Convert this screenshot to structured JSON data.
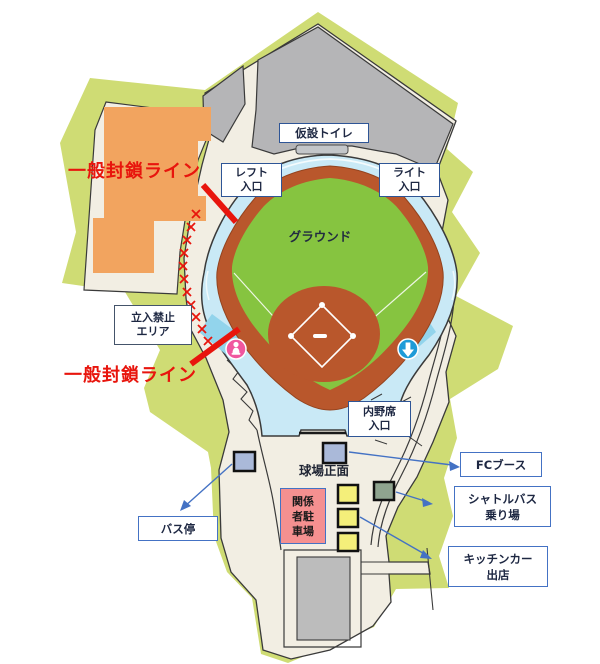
{
  "map": {
    "labels": {
      "temp_toilet": "仮設トイレ",
      "left_entrance": "レフト\n入口",
      "right_entrance": "ライト\n入口",
      "ground": "グラウンド",
      "restricted_area": "立入禁止\nエリア",
      "closure_line_upper": "一般封鎖ライン",
      "closure_line_lower": "一般封鎖ライン",
      "infield_entrance": "内野席\n入口",
      "stadium_front": "球場正面",
      "staff_parking": "関係\n者駐\n車場",
      "bus_stop": "バス停",
      "fc_booth": "FCブース",
      "shuttle_bus": "シャトルバス\n乗り場",
      "kitchen_car": "キッチンカー\n出店"
    },
    "icons": {
      "person_marker": "pink circle with white person glyph",
      "entrance_arrow": "blue circle with white down arrow",
      "closure_x_marks": "red x chain along closed path"
    },
    "colors": {
      "park_green": "#cfdc74",
      "ground_beige": "#f2eee3",
      "structure_gray": "#b5b5b7",
      "building_orange": "#f2a45f",
      "concourse_blue": "#c9e9f6",
      "entrance_cyan": "#92d4ec",
      "dirt_brown": "#b9572c",
      "field_green": "#86c440",
      "closure_red": "#e8150d",
      "marker_yellow": "#f4ef7a",
      "marker_blue_gray": "#aab9d9",
      "marker_sage": "#8fa48f",
      "parking_pink": "#f59090",
      "callout_blue": "#4472c4",
      "box_border_navy": "#2e5596"
    }
  }
}
